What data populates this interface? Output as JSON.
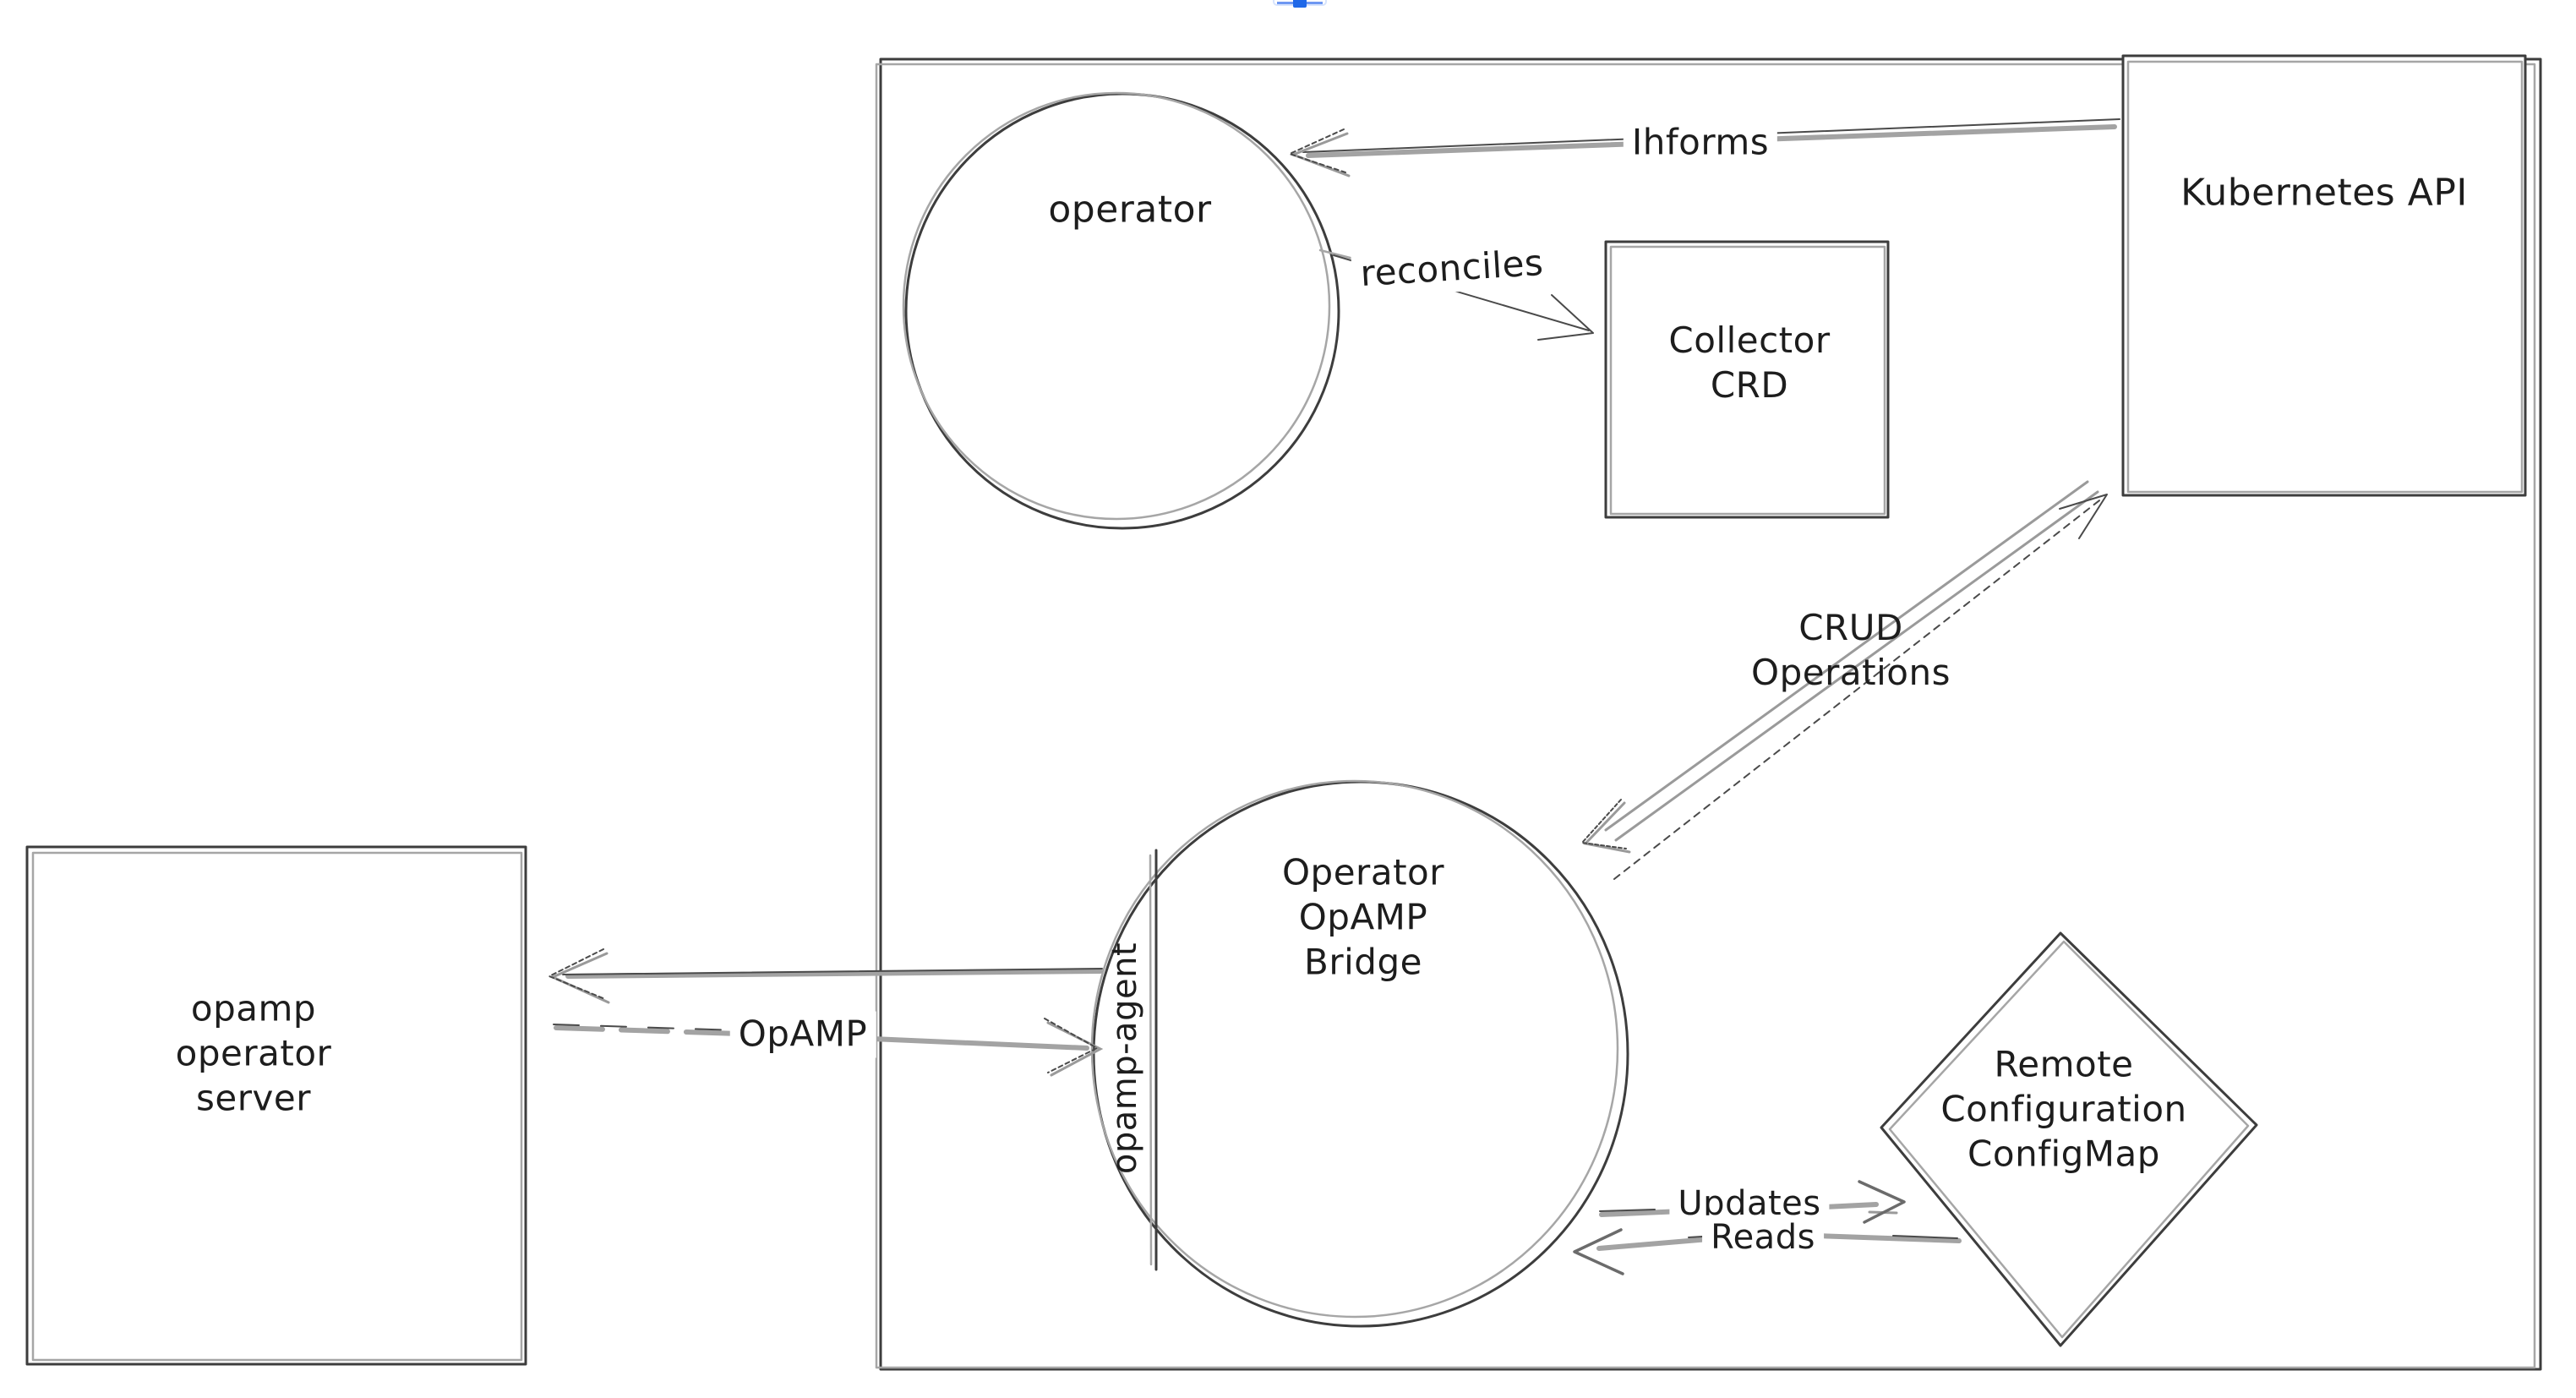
{
  "page": {
    "background": "#ffffff",
    "clipped_widget": {
      "border_color": "#d7e4fd",
      "line_color": "#6e97f2",
      "handle_color": "#1f68e8"
    }
  },
  "diagram": {
    "colors": {
      "stroke_dark": "#3d3d3d",
      "stroke_gray": "#a6a6a6",
      "arrow_gray": "#a3a3a3",
      "text": "#1d1d1d"
    },
    "nodes": {
      "operator": {
        "shape": "circle",
        "label": "operator"
      },
      "collector_crd": {
        "shape": "rectangle",
        "lines": [
          "Collector",
          "CRD"
        ]
      },
      "kubernetes_api": {
        "shape": "rectangle",
        "label": "Kubernetes API"
      },
      "opamp_bridge": {
        "shape": "circle",
        "lines": [
          "Operator",
          "OpAMP",
          "Bridge"
        ],
        "sidecar_label": "opamp-agent"
      },
      "opamp_operator_server": {
        "shape": "rectangle",
        "lines": [
          "opamp",
          "operator",
          "server"
        ]
      },
      "remote_configuration_configmap": {
        "shape": "diamond",
        "lines": [
          "Remote",
          "Configuration",
          "ConfigMap"
        ]
      }
    },
    "edges": {
      "informs": {
        "label": "Ihforms",
        "from": "kubernetes_api",
        "to": "operator"
      },
      "reconciles": {
        "label": "reconciles",
        "from": "operator",
        "to": "collector_crd"
      },
      "crud_operations": {
        "lines": [
          "CRUD",
          "Operations"
        ],
        "from": "opamp_bridge",
        "to": "kubernetes_api",
        "bidirectional": true
      },
      "opamp": {
        "label": "OpAMP",
        "from": "opamp_operator_server",
        "to": "opamp_bridge",
        "bidirectional": true
      },
      "updates": {
        "label": "Updates",
        "from": "opamp_bridge",
        "to": "remote_configuration_configmap"
      },
      "reads": {
        "label": "Reads",
        "from": "remote_configuration_configmap",
        "to": "opamp_bridge"
      }
    }
  }
}
